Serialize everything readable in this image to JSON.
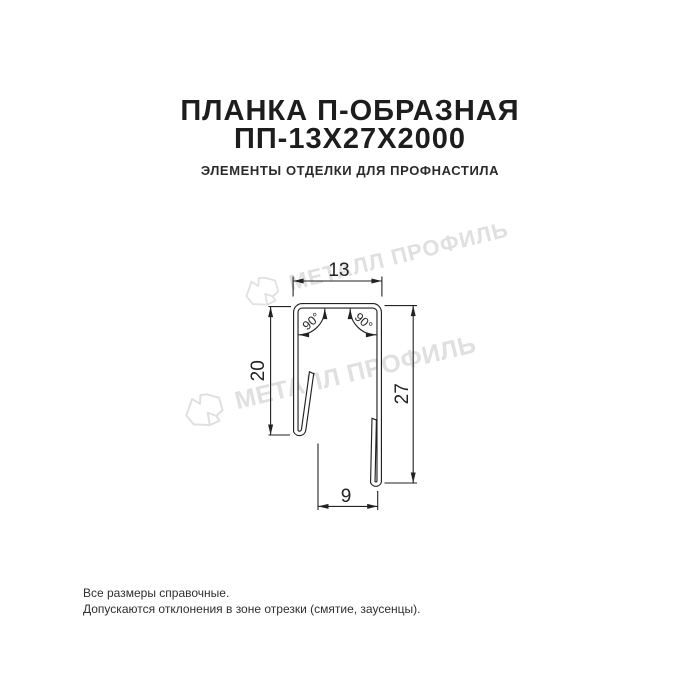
{
  "header": {
    "title_line1": "ПЛАНКА П-ОБРАЗНАЯ",
    "title_line2": "ПП-13Х27Х2000",
    "subtitle": "ЭЛЕМЕНТЫ ОТДЕЛКИ ДЛЯ ПРОФНАСТИЛА"
  },
  "watermark": {
    "brand_text": "МЕТАЛЛ ПРОФИЛЬ",
    "color": "#e0e0e0"
  },
  "drawing": {
    "dimensions": {
      "top_width": "13",
      "left_height": "20",
      "right_height": "27",
      "bottom_width": "9",
      "angle_left": "90°",
      "angle_right": "90°"
    },
    "line_color": "#222222"
  },
  "footer": {
    "note_line1": "Все размеры справочные.",
    "note_line2": "Допускаются отклонения в зоне отрезки (смятие, заусенцы)."
  }
}
